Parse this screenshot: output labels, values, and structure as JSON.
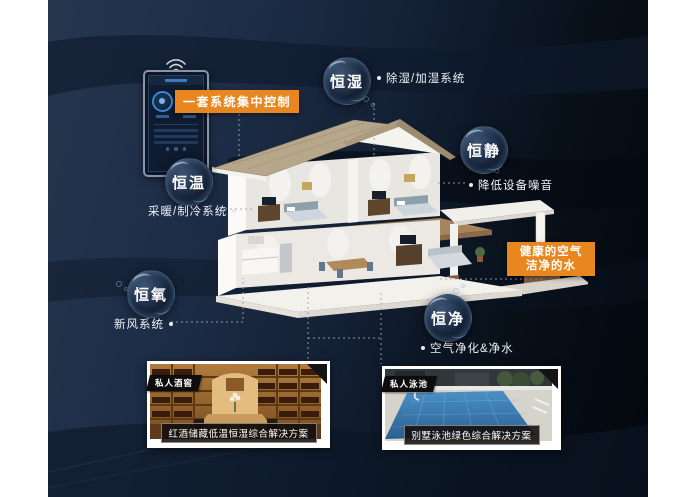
{
  "canvas": {
    "bg_left": "#26364f",
    "bg_right": "#04070d"
  },
  "colors": {
    "accent_orange": "#e8871f",
    "connector_gray": "#97a3b1",
    "bubble_text": "#ffffff",
    "annotation_text": "#eef2f6",
    "roof_tan": "#b6a68a",
    "wall_white": "#f3f1eb"
  },
  "control_panel": {
    "badge_label": "一套系统集中控制",
    "device": "smart-home-control-panel",
    "wifi_icon": "wifi"
  },
  "bubbles": [
    {
      "label": "恒湿",
      "annotation": "除湿/加湿系统"
    },
    {
      "label": "恒静",
      "annotation": "降低设备噪音"
    },
    {
      "label": "恒温",
      "annotation": "采暖/制冷系统"
    },
    {
      "label": "恒氧",
      "annotation": "新风系统"
    },
    {
      "label": "恒净",
      "annotation": "空气净化&净水"
    }
  ],
  "health_badge": {
    "line1": "健康的空气",
    "line2": "洁净的水"
  },
  "photos": [
    {
      "tag": "私人酒窖",
      "caption": "红酒储藏低温恒湿综合解决方案"
    },
    {
      "tag": "私人泳池",
      "caption": "别墅泳池绿色综合解决方案"
    }
  ]
}
